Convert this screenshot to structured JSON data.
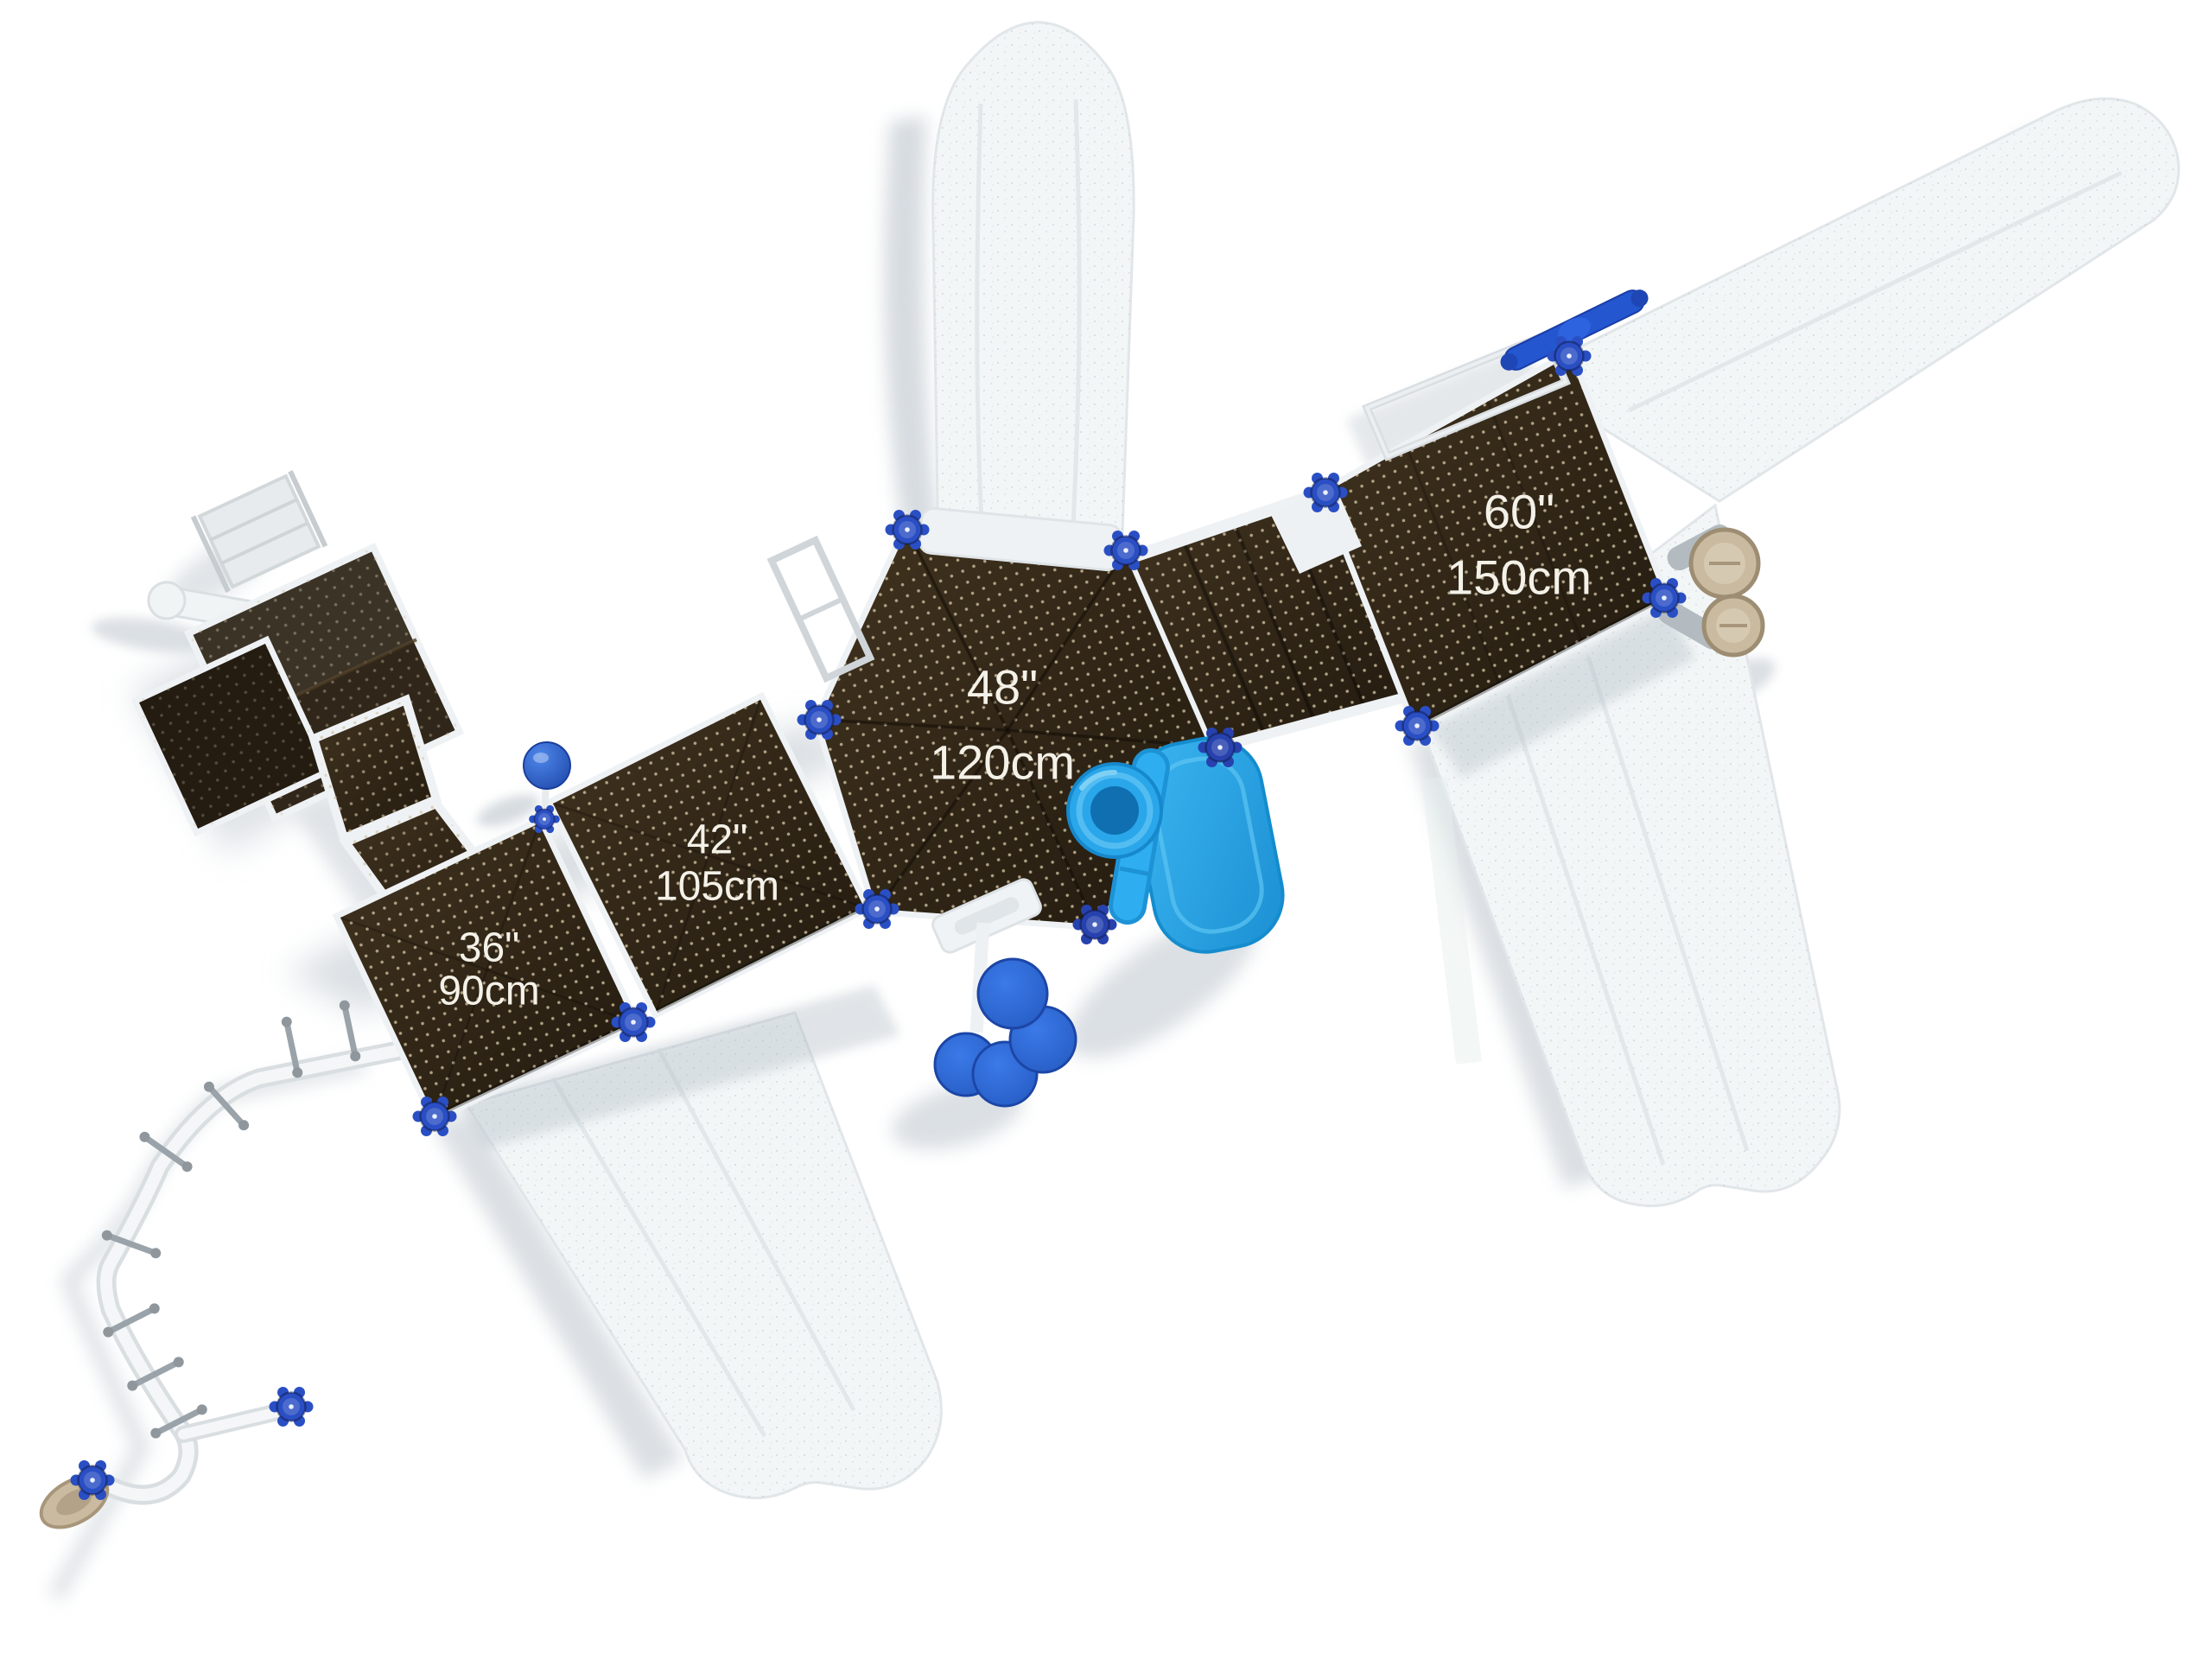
{
  "scene": {
    "view": "overhead-top-view-playground-structure",
    "background_color": "#ffffff"
  },
  "decks": [
    {
      "name": "36-inch-deck",
      "height_label": "36\"",
      "metric_label": "90cm"
    },
    {
      "name": "42-inch-deck",
      "height_label": "42\"",
      "metric_label": "105cm"
    },
    {
      "name": "48-inch-hex-deck",
      "height_label": "48\"",
      "metric_label": "120cm"
    },
    {
      "name": "60-inch-deck",
      "height_label": "60\"",
      "metric_label": "150cm"
    }
  ],
  "components": {
    "post_cap": "blue-gear-post-cap",
    "climber": "curved-pole-climber",
    "tube_slide": "blue-tube-slide-entrance",
    "slide_panel": "blue-slide-panel",
    "steppers": "blue-disc-steppers",
    "ball": "blue-ball-topper",
    "telescope": "tan-double-telescope",
    "roof": "square-roof-panels",
    "ground_slides": "white-speckled-slides",
    "grab_bar": "blue-grab-bar",
    "handrail_loop": "overhead-handrail-loop"
  },
  "colors": {
    "deck_brown": "#2f2518",
    "deck_brown_light": "#41331f",
    "deck_dot_tan": "#cec0a0",
    "slide_white": "#f3f6f7",
    "speckle_gray": "#a9b4ba",
    "shadow_gray": "#c8d0d6",
    "post_cap_blue": "#2a4fc4",
    "tube_slide_cyan": "#2aa7e9",
    "disc_blue": "#2f6cd8",
    "ball_blue": "#2a64d4",
    "telescope_tan": "#c6b69b",
    "rail_gray": "#d2d8db",
    "label_text": "#f4f1e8"
  }
}
